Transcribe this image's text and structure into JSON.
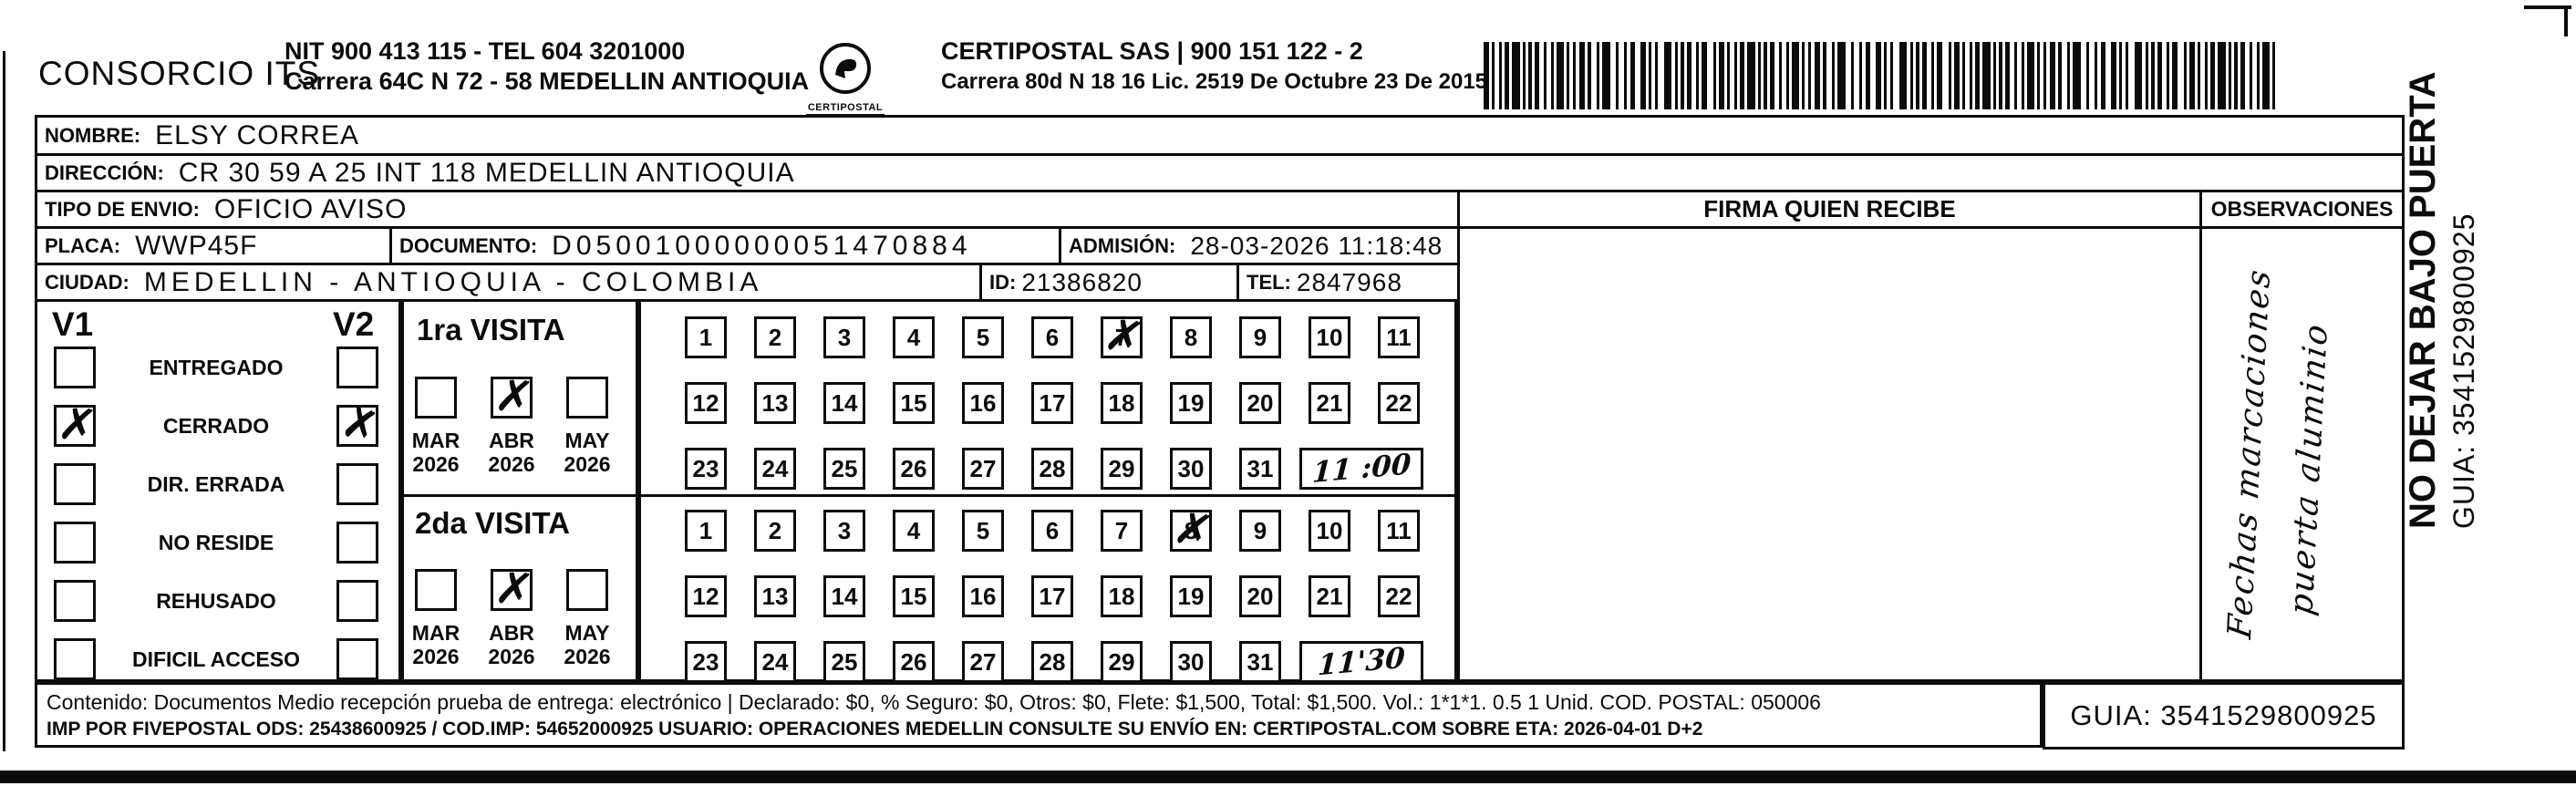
{
  "header": {
    "company": "CONSORCIO ITS",
    "company_info_line1": "NIT 900 413 115 - TEL 604 3201000",
    "company_info_line2": "Carrera 64C N 72 - 58 MEDELLIN ANTIOQUIA",
    "logo_caption": "CERTIPOSTAL",
    "operator_line1": "CERTIPOSTAL SAS | 900 151 122 - 2",
    "operator_line2": "Carrera 80d N 18 16  Lic. 2519 De Octubre 23 De 2015"
  },
  "shipment": {
    "nombre_label": "NOMBRE:",
    "nombre": "ELSY CORREA",
    "direccion_label": "DIRECCIÓN:",
    "direccion": "CR 30 59 A 25 INT 118 MEDELLIN ANTIOQUIA",
    "tipo_envio_label": "TIPO DE ENVIO:",
    "tipo_envio": "OFICIO AVISO",
    "placa_label": "PLACA:",
    "placa": "WWP45F",
    "documento_label": "DOCUMENTO:",
    "documento": "D05001000000051470884",
    "admision_label": "ADMISIÓN:",
    "admision": "28-03-2026 11:18:48",
    "ciudad_label": "CIUDAD:",
    "ciudad": "MEDELLIN - ANTIOQUIA - COLOMBIA",
    "id_label": "ID:",
    "id_value": "21386820",
    "tel_label": "TEL:",
    "tel": "2847968"
  },
  "delivery_status": {
    "v1_label": "V1",
    "v2_label": "V2",
    "mark_glyph": "✗",
    "items": [
      {
        "label": "ENTREGADO",
        "v1_checked": false,
        "v2_checked": false
      },
      {
        "label": "CERRADO",
        "v1_checked": true,
        "v2_checked": true
      },
      {
        "label": "DIR. ERRADA",
        "v1_checked": false,
        "v2_checked": false
      },
      {
        "label": "NO RESIDE",
        "v1_checked": false,
        "v2_checked": false
      },
      {
        "label": "REHUSADO",
        "v1_checked": false,
        "v2_checked": false
      },
      {
        "label": "DIFICIL ACCESO",
        "v1_checked": false,
        "v2_checked": false
      }
    ]
  },
  "visits": [
    {
      "title": "1ra VISITA",
      "months": [
        {
          "month": "MAR",
          "year": "2026",
          "checked": false
        },
        {
          "month": "ABR",
          "year": "2026",
          "checked": true
        },
        {
          "month": "MAY",
          "year": "2026",
          "checked": false
        }
      ],
      "marked_day": 7,
      "time_note": "11 :00"
    },
    {
      "title": "2da VISITA",
      "months": [
        {
          "month": "MAR",
          "year": "2026",
          "checked": false
        },
        {
          "month": "ABR",
          "year": "2026",
          "checked": true
        },
        {
          "month": "MAY",
          "year": "2026",
          "checked": false
        }
      ],
      "marked_day": 8,
      "time_note": "11'30"
    }
  ],
  "calendar_rows": [
    [
      1,
      2,
      3,
      4,
      5,
      6,
      7,
      8,
      9,
      10,
      11
    ],
    [
      12,
      13,
      14,
      15,
      16,
      17,
      18,
      19,
      20,
      21,
      22
    ],
    [
      23,
      24,
      25,
      26,
      27,
      28,
      29,
      30,
      31
    ]
  ],
  "signature_section": {
    "firma_header": "FIRMA QUIEN RECIBE",
    "observaciones_header": "OBSERVACIONES",
    "observaciones_note_line1": "Fechas marcaciones",
    "observaciones_note_line2": "puerta aluminio"
  },
  "footer": {
    "contenido_line": "Contenido: Documentos Medio recepción prueba de entrega: electrónico | Declarado: $0, % Seguro: $0, Otros: $0, Flete: $1,500, Total: $1,500. Vol.: 1*1*1. 0.5  1 Unid. COD. POSTAL: 050006",
    "imp_line": "IMP POR FIVEPOSTAL ODS: 25438600925 / COD.IMP: 54652000925 USUARIO: OPERACIONES MEDELLIN CONSULTE SU ENVÍO EN: CERTIPOSTAL.COM SOBRE ETA: 2026-04-01 D+2",
    "guia": "GUIA: 3541529800925"
  },
  "side_annotation": {
    "line1": "NO DEJAR BAJO PUERTA",
    "line2": "GUIA: 3541529800925"
  },
  "artifacts": {
    "ink_mark": "’"
  }
}
